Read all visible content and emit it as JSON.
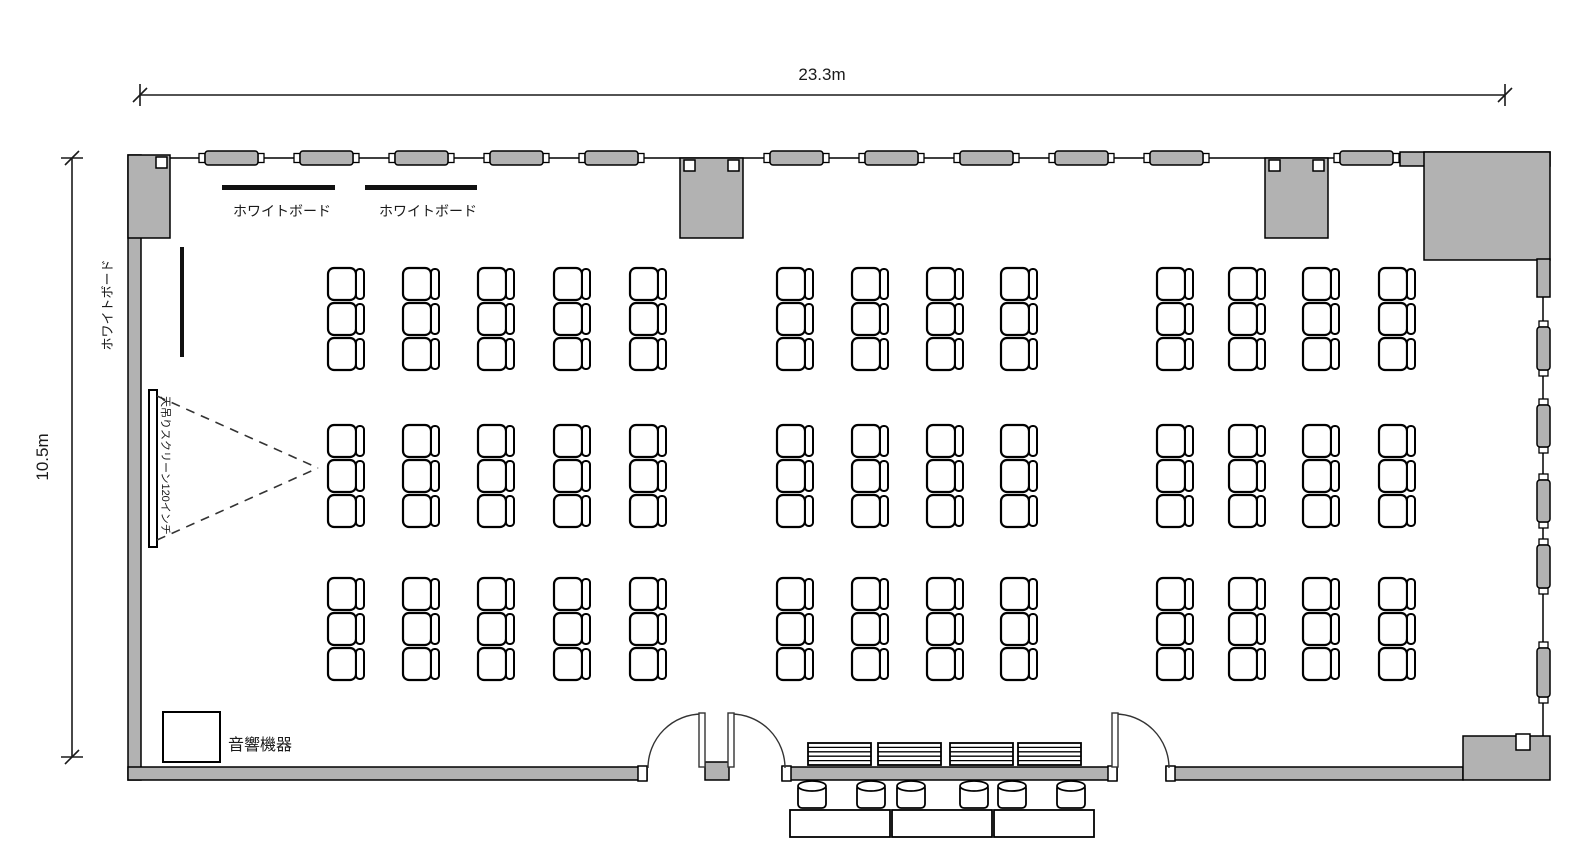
{
  "plan_title": "seminar-room-floor-plan",
  "dimensions": {
    "width_label": "23.3m",
    "height_label": "10.5m"
  },
  "labels": {
    "whiteboard_top_left": "ホワイトボード",
    "whiteboard_top_right": "ホワイトボード",
    "whiteboard_side": "ホワイトボード",
    "ceiling_screen": "天吊りスクリーン120インチ",
    "audio_equipment": "音響機器"
  },
  "colors": {
    "wall_gray": "#b2b2b2",
    "outline": "#000000",
    "background": "#ffffff"
  },
  "windows": {
    "top": {
      "y": 151,
      "w": 53,
      "h": 14,
      "xs": [
        205,
        300,
        395,
        490,
        585,
        770,
        865,
        960,
        1055,
        1150,
        1340
      ]
    },
    "right": {
      "x": 1537,
      "w": 13,
      "capsules": [
        {
          "y": 327,
          "h": 43
        },
        {
          "y": 405,
          "h": 42
        },
        {
          "y": 480,
          "h": 42
        },
        {
          "y": 545,
          "h": 43
        },
        {
          "y": 648,
          "h": 49
        }
      ]
    }
  },
  "seating": {
    "chair": {
      "seat_w": 28,
      "seat_h": 32,
      "back_w": 8
    },
    "row_y_bands": [
      [
        268,
        303,
        338
      ],
      [
        425,
        460,
        495
      ],
      [
        578,
        613,
        648
      ]
    ],
    "column_x_groups": [
      [
        328,
        403,
        478,
        554,
        630
      ],
      [
        777,
        852,
        927,
        1001
      ],
      [
        1157,
        1229,
        1303,
        1379
      ]
    ],
    "chairs_per_column": 3,
    "total_chairs": 117
  },
  "furniture": {
    "stacked_tables": {
      "y": 743,
      "w": 63,
      "h": 22,
      "xs": [
        808,
        878,
        950,
        1018
      ]
    },
    "stools": {
      "y": 780,
      "w": 28,
      "h": 28,
      "xs": [
        798,
        857,
        897,
        960,
        998,
        1057
      ]
    },
    "outside_tables": {
      "y": 810,
      "w": 100,
      "h": 27,
      "xs": [
        790,
        892,
        994
      ]
    }
  }
}
